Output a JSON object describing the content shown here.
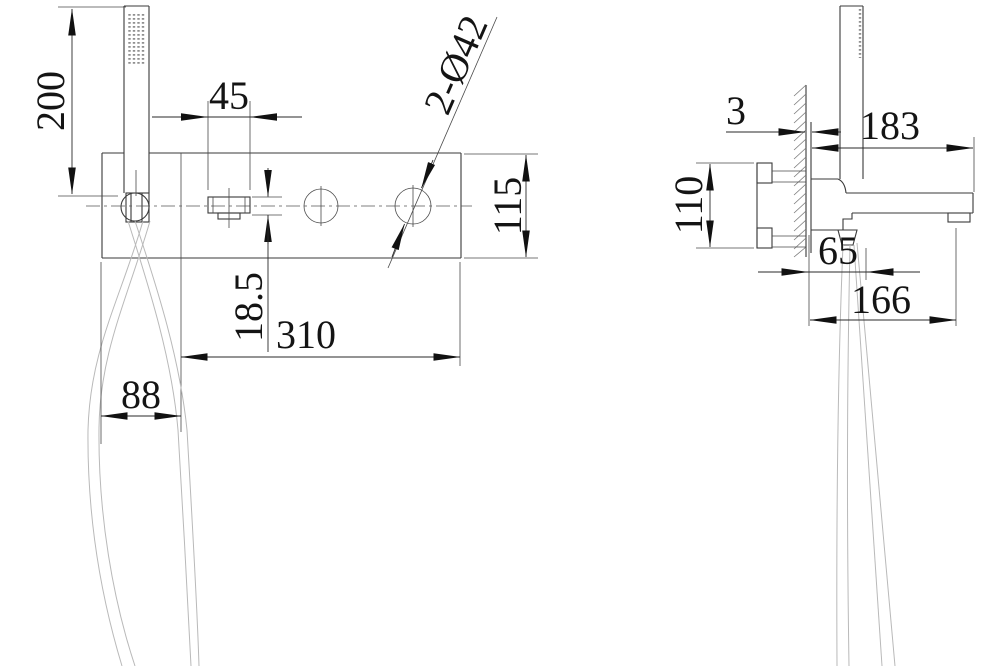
{
  "front_view": {
    "dim_shower_height": "200",
    "dim_handle_width": "45",
    "dim_plate_height": "115",
    "dim_handle_height": "18.5",
    "dim_body_width": "310",
    "dim_holder_section_width": "88",
    "callout_holes": "2-Ø42"
  },
  "side_view": {
    "dim_plate_offset": "3",
    "dim_spout_reach": "183",
    "dim_inlet_spacing": "110",
    "dim_hose_outlet_offset": "65",
    "dim_outlet_reach": "166"
  },
  "colors": {
    "background": "#ffffff",
    "outline": "#3a3a3a",
    "dimension": "#141414",
    "hose": "#b9b9b9"
  }
}
